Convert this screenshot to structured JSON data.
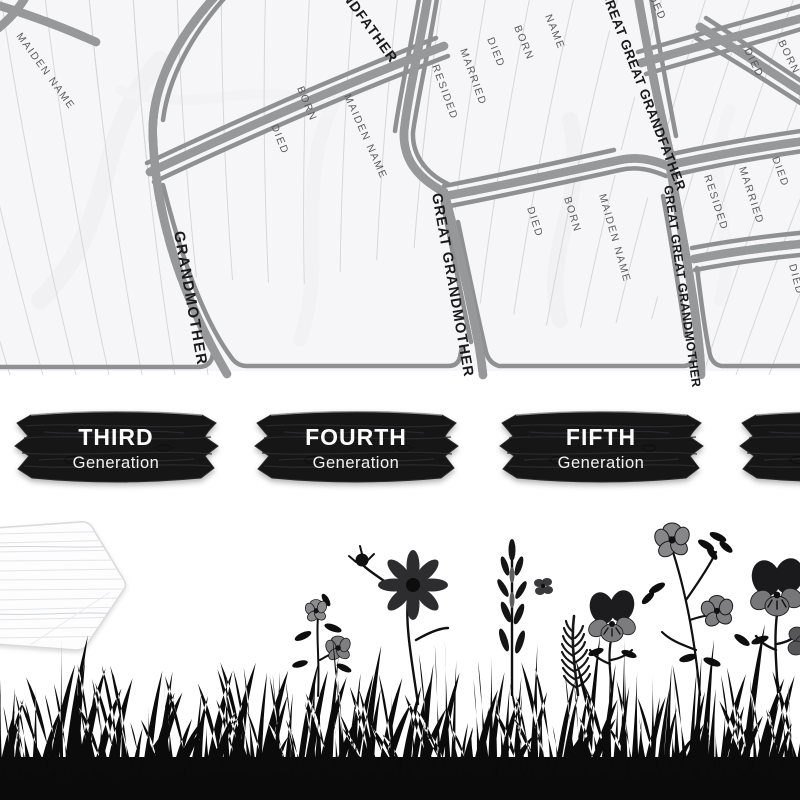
{
  "fan": {
    "section_labels": [
      "GRANDMOTHER",
      "GREAT GRANDMOTHER",
      "GREAT GREAT GRANDFATHER",
      "GREAT GREAT GRANDMOTHER",
      "GRANDFATHER"
    ],
    "field_labels": [
      "MAIDEN NAME",
      "DIED",
      "BORN",
      "MAIDEN NAME",
      "RESIDED",
      "MARRIED",
      "DIED",
      "BORN",
      "NAME",
      "DIED",
      "BORN",
      "MAIDEN NAME",
      "RESIDED",
      "MARRIED",
      "DIED",
      "DIED",
      "BORN",
      "RESIDED",
      "DIED"
    ]
  },
  "signs": {
    "items": [
      {
        "title": "THIRD",
        "subtitle": "Generation"
      },
      {
        "title": "FOURTH",
        "subtitle": "Generation"
      },
      {
        "title": "FIFTH",
        "subtitle": "Generation"
      },
      {
        "title": "",
        "subtitle": ""
      }
    ]
  },
  "decor": {
    "arrow_sign": "blank-wood-arrow-sign",
    "grass": "grass-silhouette",
    "flowers": [
      "wild-rose-sprig",
      "cosmos-flower",
      "bellflower-stalk",
      "feather-leaf",
      "pansy",
      "rose-sprig",
      "large-pansy",
      "small-blossom"
    ]
  },
  "colors": {
    "paper": "#f6f6f8",
    "ruled_line": "#d7d7db",
    "cell_border": "#8f9092",
    "branch_dark": "#333438",
    "branch_halo": "#97989a",
    "section_text": "#1a1a1c",
    "field_text": "#5c5c60",
    "sign_wood": "#161616",
    "sign_text": "#fafafa",
    "silhouette": "#0a0a0b"
  }
}
